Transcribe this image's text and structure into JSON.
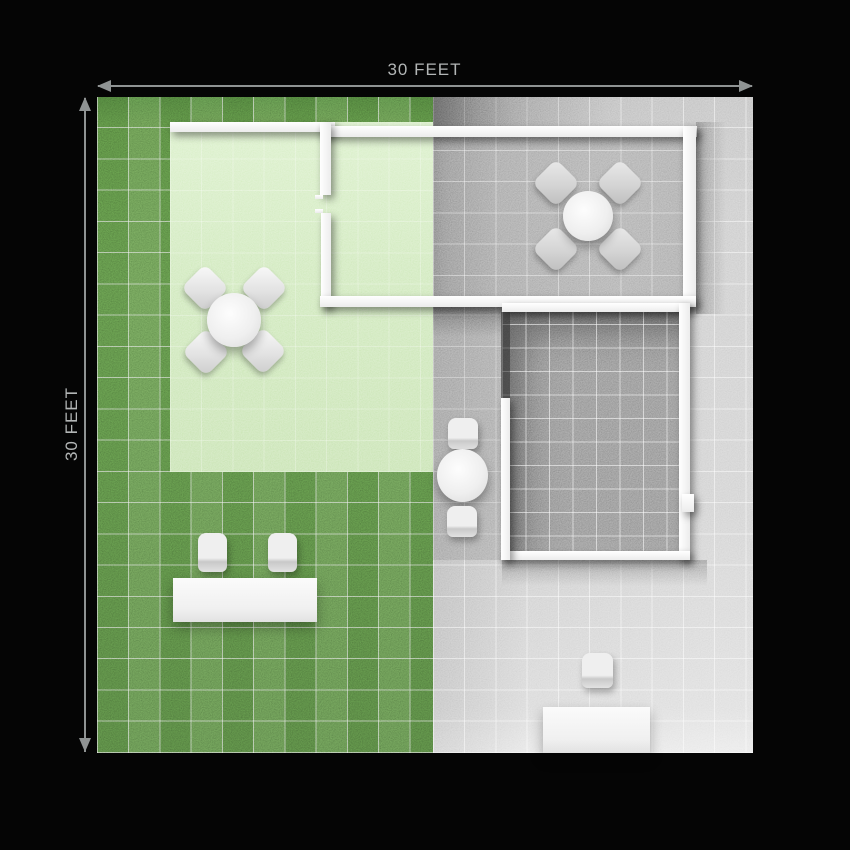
{
  "page": {
    "title": "30 x 30 feet site plan render",
    "background_color": "#000000"
  },
  "dimensions": {
    "top": {
      "label": "30 FEET",
      "value_feet": 30
    },
    "left": {
      "label": "30 FEET",
      "value_feet": 30
    }
  },
  "plot": {
    "zones": [
      {
        "id": "grass-yard",
        "desc": "dark green grass lawn with white grid",
        "color": "#5a8845"
      },
      {
        "id": "paved-yard",
        "desc": "light gray paved patio with white grid",
        "color": "#c6c6c6"
      },
      {
        "id": "grass-room",
        "desc": "light green walled garden room",
        "color": "#cfe9bb"
      },
      {
        "id": "dining-room",
        "desc": "upper right walled room, gray floor",
        "color": "#a8a8a8"
      },
      {
        "id": "inner-room",
        "desc": "lower right walled room, dark gray tile floor",
        "color": "#909090"
      }
    ],
    "wall_color": "#f4f4f4",
    "furniture": [
      {
        "id": "grass-dining-set",
        "desc": "round table with 4 diamond chairs in light green room"
      },
      {
        "id": "room-dining-set",
        "desc": "round table with 4 diamond chairs in upper right room"
      },
      {
        "id": "bistro-set",
        "desc": "round table with 2 chairs on center walkway"
      },
      {
        "id": "bench-set",
        "desc": "long bench table with 2 chairs on lawn"
      },
      {
        "id": "entry-set",
        "desc": "table with single chair at bottom walkway"
      }
    ]
  }
}
